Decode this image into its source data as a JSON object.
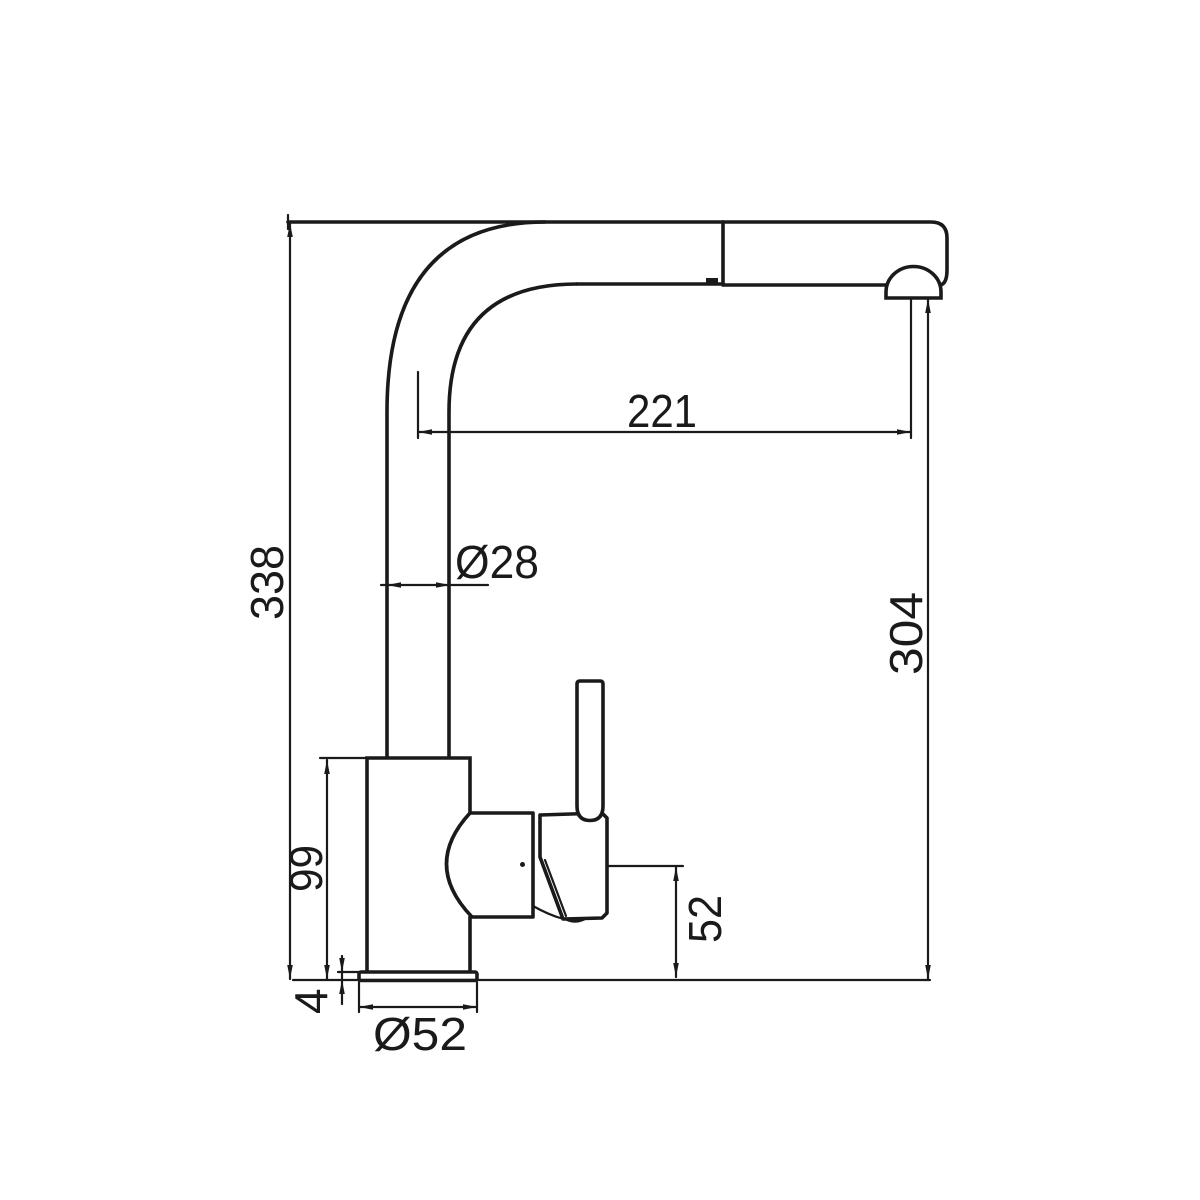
{
  "drawing": {
    "background": "#ffffff",
    "line_color": "#1a1a1a",
    "dims": {
      "spout_reach": "221",
      "spout_tube_diameter": "Ø28",
      "overall_height": "338",
      "outlet_height": "304",
      "body_height": "99",
      "handle_base_height": "52",
      "base_plate_thickness": "4",
      "base_diameter": "Ø52"
    }
  }
}
